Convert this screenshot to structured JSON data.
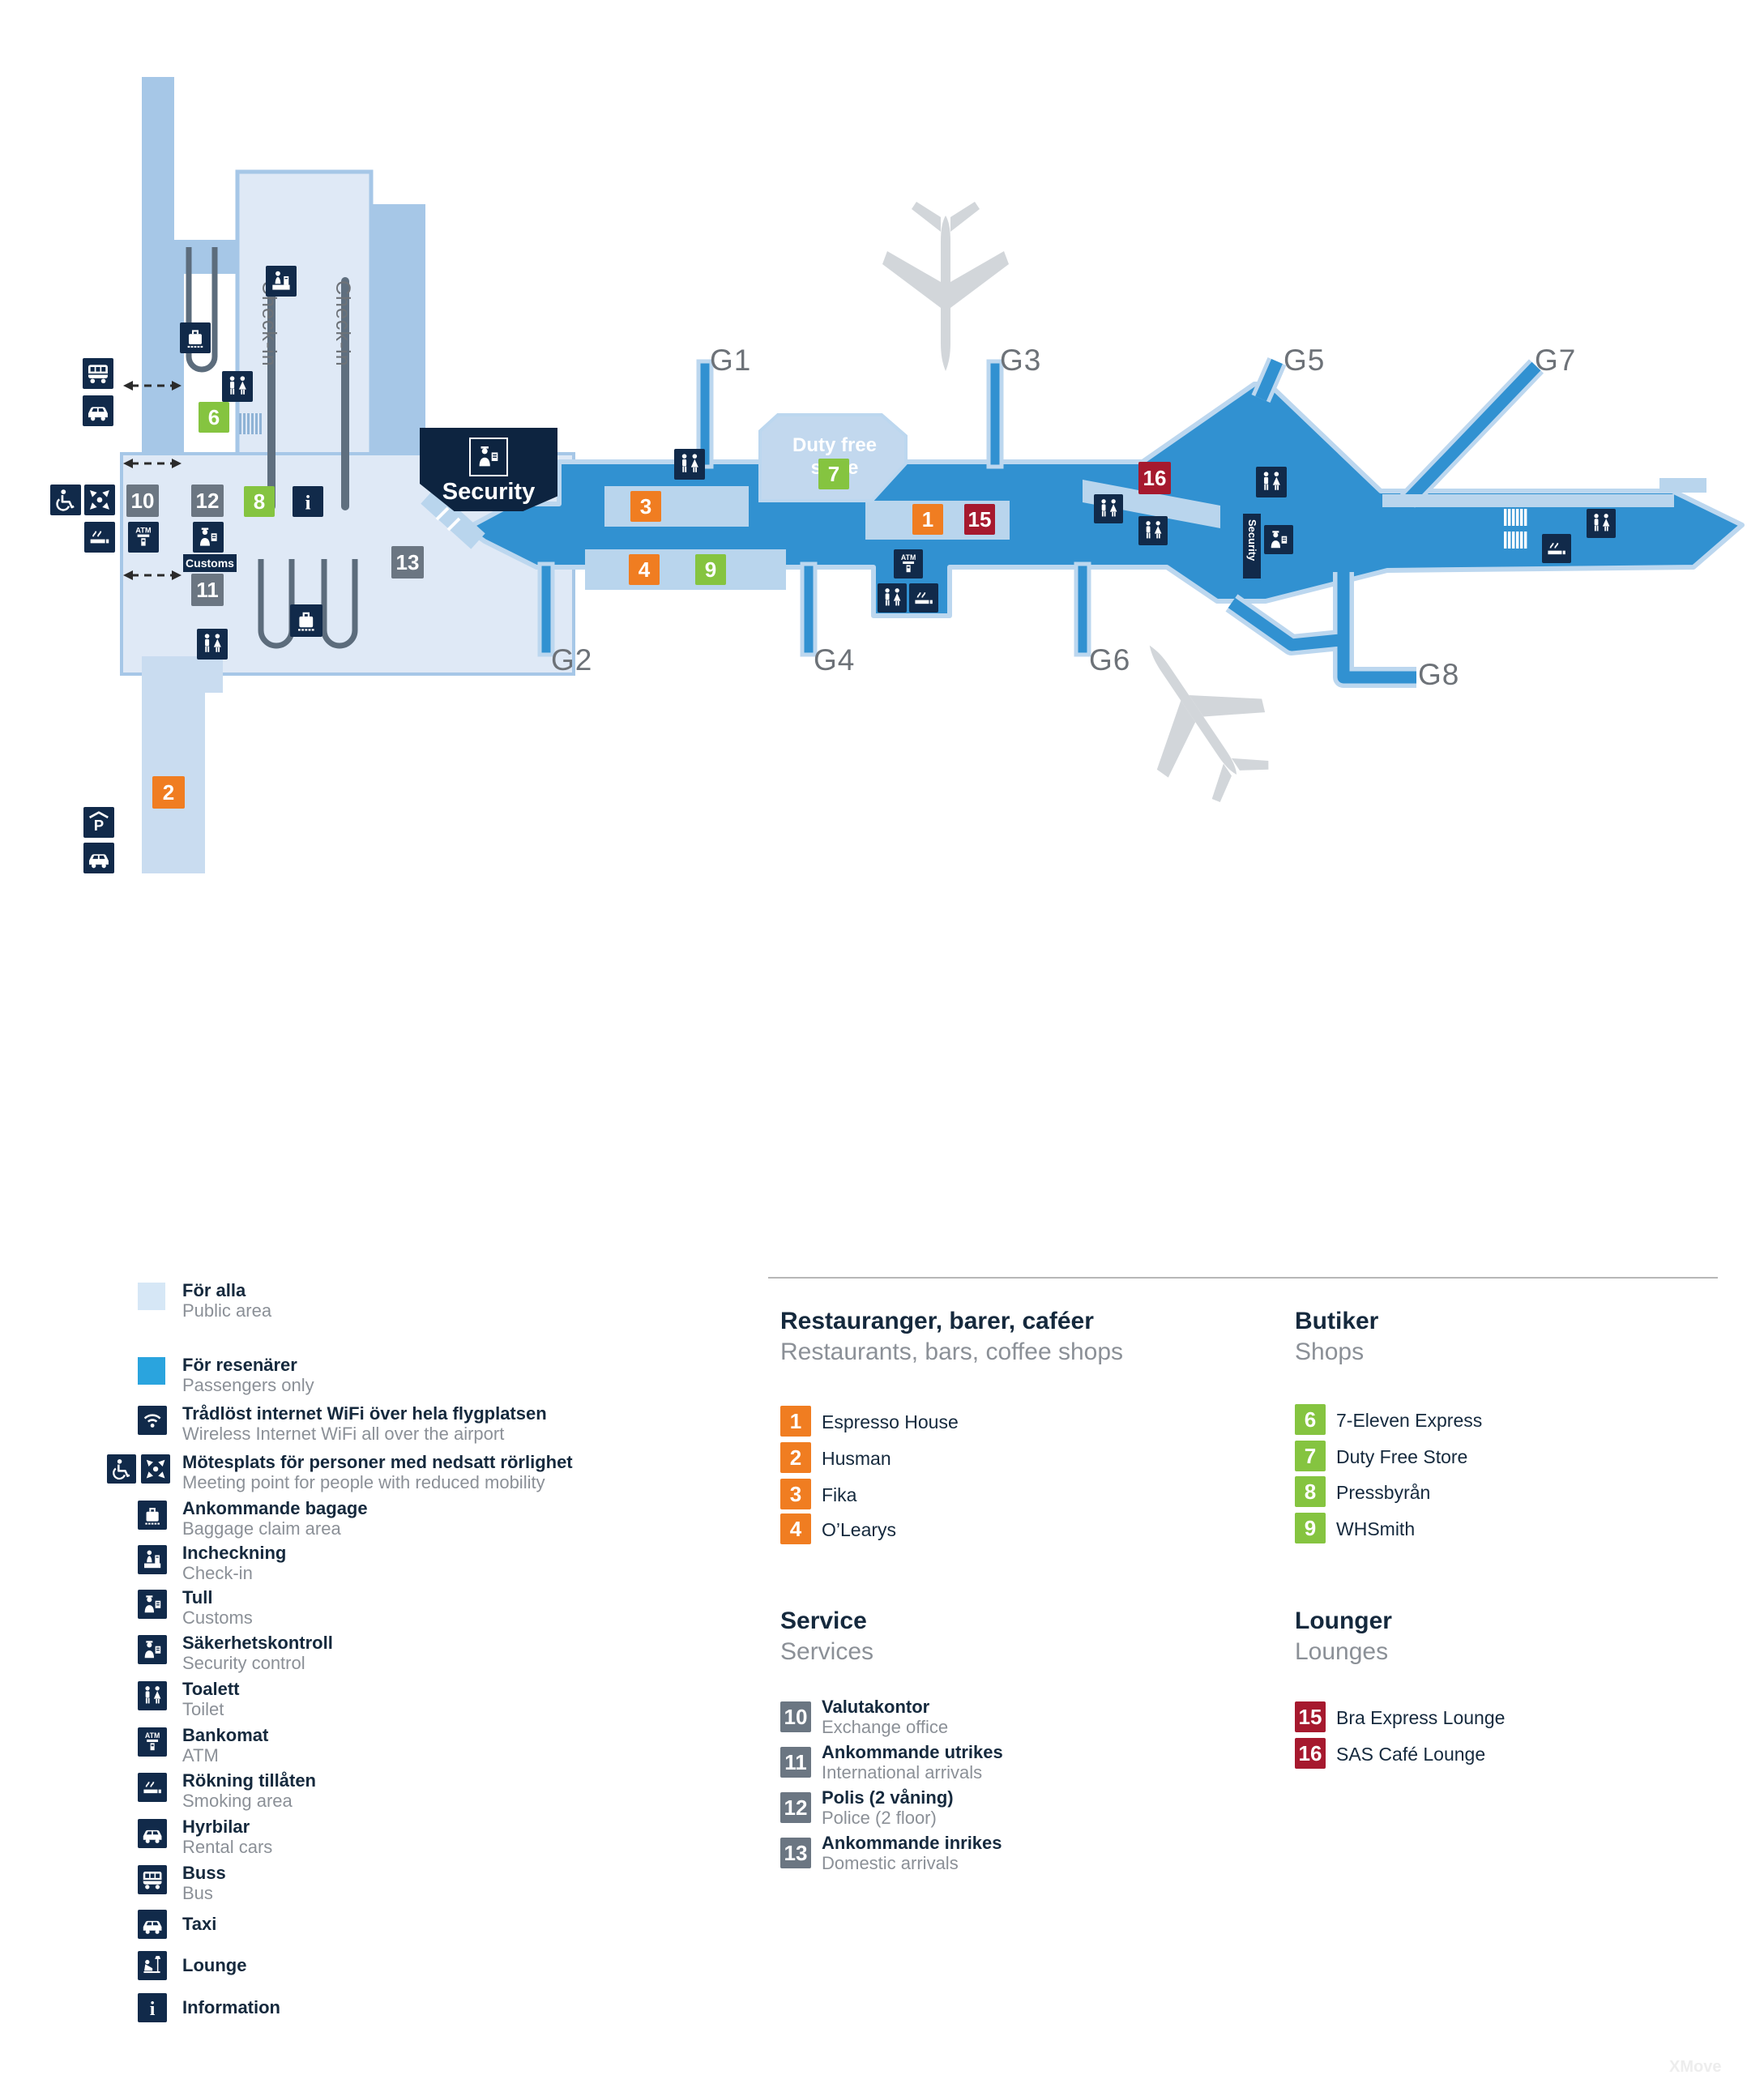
{
  "map": {
    "gates": {
      "g1": "G1",
      "g2": "G2",
      "g3": "G3",
      "g4": "G4",
      "g5": "G5",
      "g6": "G6",
      "g7": "G7",
      "g8": "G8"
    },
    "badges": {
      "b1": "1",
      "b2": "2",
      "b3": "3",
      "b4": "4",
      "b6": "6",
      "b7": "7",
      "b8": "8",
      "b9": "9",
      "b10": "10",
      "b11": "11",
      "b12": "12",
      "b13": "13",
      "b15": "15",
      "b16": "16"
    },
    "labels": {
      "security_box": "Security",
      "security_small": "Security",
      "customs": "Customs",
      "checkin_1": "Check-in",
      "checkin_2": "Check-in",
      "duty_free": "Duty free store",
      "atm": "ATM"
    }
  },
  "colors": {
    "public_area": "#d9e6f4",
    "public_mid": "#a6c7e7",
    "passengers_only": "#2aa4de",
    "pier_blue": "#3191d1",
    "pale_band": "#b9d5ed",
    "navy": "#112a4a",
    "orange": "#f07d21",
    "green": "#85c440",
    "red": "#a6192e",
    "gray": "#6b7682"
  },
  "legend": {
    "areas": [
      {
        "sv": "För alla",
        "en": "Public area",
        "color": "#d6e7f6"
      },
      {
        "sv": "För resenärer",
        "en": "Passengers only",
        "color": "#2aa4de"
      }
    ],
    "facilities": [
      {
        "icon": "wifi-icon",
        "sv": "Trådlöst internet WiFi över hela flygplatsen",
        "en": "Wireless Internet WiFi all over the airport"
      },
      {
        "icon": "wheelchair-icon meeting-point-icon",
        "sv": "Mötesplats för personer med nedsatt rörlighet",
        "en": "Meeting point for people with reduced mobility"
      },
      {
        "icon": "baggage-icon",
        "sv": "Ankommande bagage",
        "en": "Baggage claim area"
      },
      {
        "icon": "checkin-icon",
        "sv": "Incheckning",
        "en": "Check-in"
      },
      {
        "icon": "customs-icon",
        "sv": "Tull",
        "en": "Customs"
      },
      {
        "icon": "security-icon",
        "sv": "Säkerhetskontroll",
        "en": "Security control"
      },
      {
        "icon": "toilet-icon",
        "sv": "Toalett",
        "en": "Toilet"
      },
      {
        "icon": "atm-icon",
        "sv": "Bankomat",
        "en": "ATM"
      },
      {
        "icon": "smoking-icon",
        "sv": "Rökning tillåten",
        "en": "Smoking area"
      },
      {
        "icon": "rental-car-icon",
        "sv": "Hyrbilar",
        "en": "Rental cars"
      },
      {
        "icon": "bus-icon",
        "sv": "Buss",
        "en": "Bus"
      },
      {
        "icon": "taxi-icon",
        "sv": "Taxi",
        "en": ""
      },
      {
        "icon": "lounge-icon",
        "sv": "Lounge",
        "en": ""
      },
      {
        "icon": "info-icon",
        "sv": "Information",
        "en": ""
      }
    ],
    "sections": {
      "restaurants": {
        "title_sv": "Restauranger, barer, caféer",
        "title_en": "Restaurants, bars, coffee shops",
        "items": [
          {
            "n": "1",
            "name": "Espresso House"
          },
          {
            "n": "2",
            "name": "Husman"
          },
          {
            "n": "3",
            "name": "Fika"
          },
          {
            "n": "4",
            "name": "O’Learys"
          }
        ]
      },
      "shops": {
        "title_sv": "Butiker",
        "title_en": "Shops",
        "items": [
          {
            "n": "6",
            "name": "7-Eleven Express"
          },
          {
            "n": "7",
            "name": "Duty Free Store"
          },
          {
            "n": "8",
            "name": "Pressbyrån"
          },
          {
            "n": "9",
            "name": "WHSmith"
          }
        ]
      },
      "services": {
        "title_sv": "Service",
        "title_en": "Services",
        "items": [
          {
            "n": "10",
            "sv": "Valutakontor",
            "en": "Exchange office"
          },
          {
            "n": "11",
            "sv": "Ankommande utrikes",
            "en": "International arrivals"
          },
          {
            "n": "12",
            "sv": "Polis (2 våning)",
            "en": "Police (2 floor)"
          },
          {
            "n": "13",
            "sv": "Ankommande inrikes",
            "en": "Domestic arrivals"
          }
        ]
      },
      "lounges": {
        "title_sv": "Lounger",
        "title_en": "Lounges",
        "items": [
          {
            "n": "15",
            "name": "Bra Express Lounge"
          },
          {
            "n": "16",
            "name": "SAS Café Lounge"
          }
        ]
      }
    }
  },
  "watermark": {
    "text": "XMove"
  }
}
